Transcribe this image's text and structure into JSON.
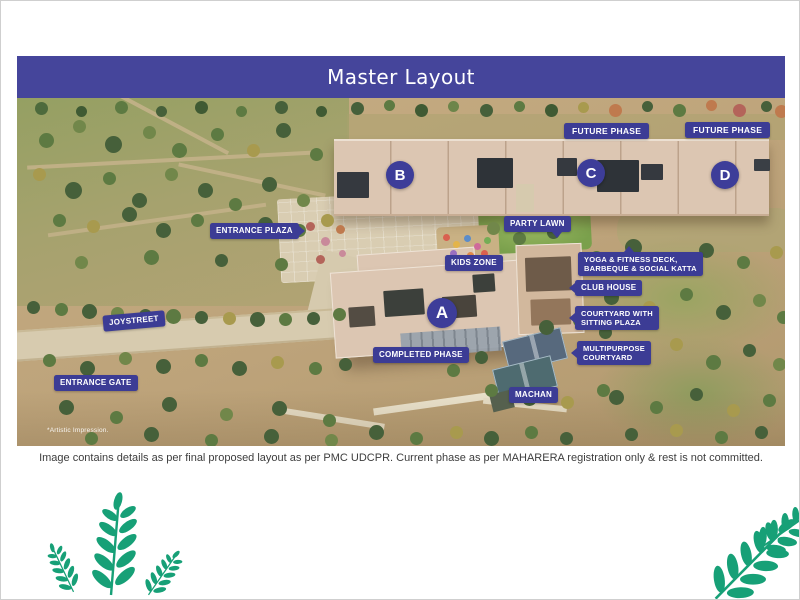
{
  "header": {
    "title": "Master Layout"
  },
  "map": {
    "artistic_note": "*Artistic Impression.",
    "markers": [
      {
        "letter": "B"
      },
      {
        "letter": "C"
      },
      {
        "letter": "D"
      },
      {
        "letter": "A"
      }
    ],
    "labels": [
      {
        "text": "FUTURE PHASE"
      },
      {
        "text": "FUTURE PHASE"
      },
      {
        "text": "ENTRANCE PLAZA"
      },
      {
        "text": "PARTY LAWN"
      },
      {
        "text": "KIDS ZONE"
      },
      {
        "lines": [
          "YOGA & FITNESS DECK,",
          "BARBEQUE & SOCIAL KATTA"
        ]
      },
      {
        "text": "CLUB HOUSE"
      },
      {
        "lines": [
          "COURTYARD WITH",
          "SITTING PLAZA"
        ]
      },
      {
        "lines": [
          "MULTIPURPOSE",
          "COURTYARD"
        ]
      },
      {
        "text": "JOYSTREET"
      },
      {
        "text": "ENTRANCE GATE"
      },
      {
        "text": "COMPLETED PHASE"
      },
      {
        "text": "MACHAN"
      }
    ]
  },
  "footer": {
    "caption": "Image contains details as per final proposed layout as per PMC UDCPR. Current phase as per MAHARERA registration only & rest is not committed."
  },
  "colors": {
    "header_bg": "#45459B",
    "badge_bg": "#3C3C95",
    "marker_bg": "#3D3D99",
    "leaf_green": "#17A077"
  }
}
